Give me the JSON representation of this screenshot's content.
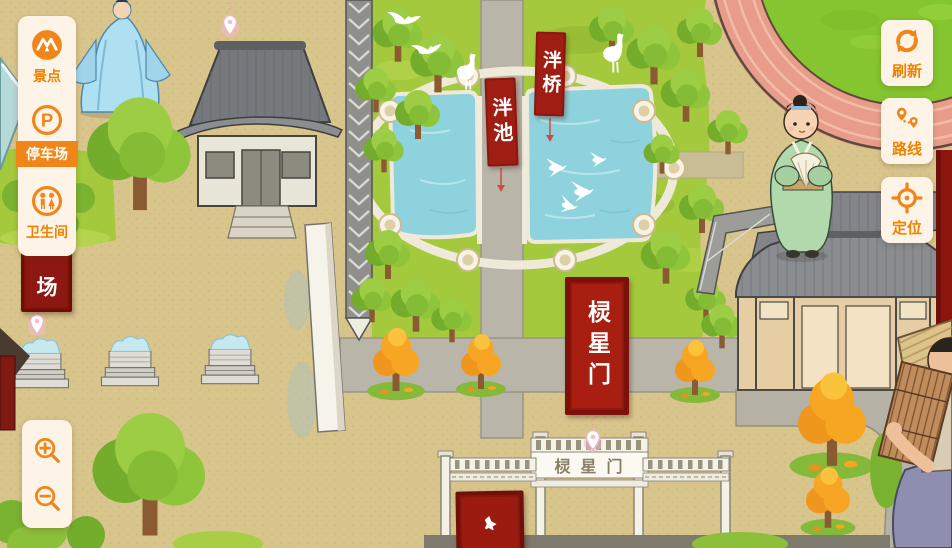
{
  "ui": {
    "sidebar": {
      "items": [
        {
          "label": "景点",
          "icon": "scenic-spot-icon",
          "selected": false
        },
        {
          "label": "停车场",
          "icon": "parking-icon",
          "selected": true
        },
        {
          "label": "卫生间",
          "icon": "restroom-icon",
          "selected": false
        }
      ]
    },
    "map_controls": [
      {
        "label": "刷新",
        "icon": "refresh-icon"
      },
      {
        "label": "路线",
        "icon": "route-icon"
      },
      {
        "label": "定位",
        "icon": "locate-icon"
      }
    ],
    "zoom_controls": [
      {
        "icon": "zoom-in-icon"
      },
      {
        "icon": "zoom-out-icon"
      }
    ]
  },
  "map": {
    "labels": {
      "pan_bridge": "泮桥",
      "pan_pond": "泮池",
      "lingxing_gate_banner": "棂星门",
      "gate_plaque": "棂星门",
      "plaza_partial": "场"
    },
    "colors": {
      "accent_orange": "#f08200",
      "panel_cream": "#fdf4e7",
      "banner_red": "#a01d14",
      "banner_border_red": "#7c110b",
      "ground_tan": "#d8c58c",
      "grass_green": "#a4c93d",
      "pond_blue": "#8ed2dd",
      "ring_road_pink": "#e89d8a"
    }
  }
}
